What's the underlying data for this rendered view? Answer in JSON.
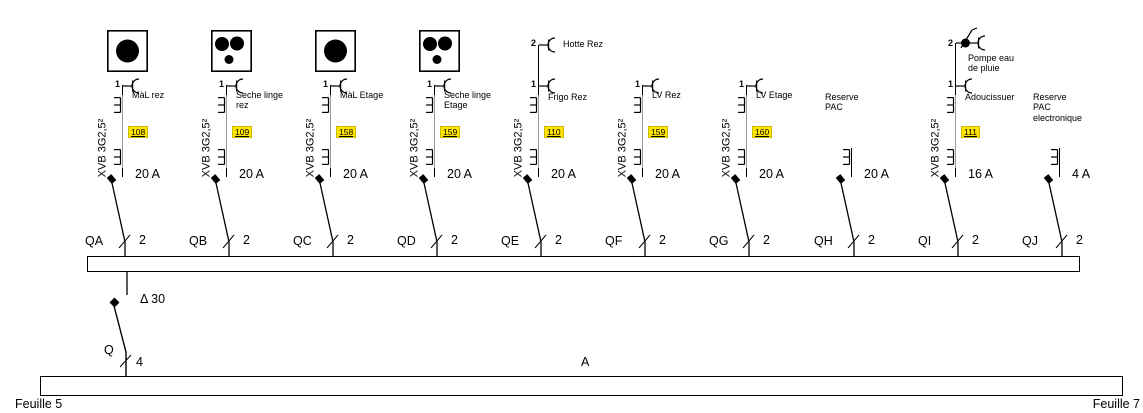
{
  "diagram": {
    "footer": {
      "left": "Feuille 5",
      "right": "Feuille 7"
    },
    "lower_bus_label": "A",
    "main_breaker": {
      "id": "Q",
      "poles": "4",
      "differential": "Δ 30"
    },
    "icons": {
      "washing_machine": "washing-machine-icon",
      "tumble_dryer": "tumble-dryer-icon",
      "pump_switch": "pump-switch-icon",
      "socket_outlet": "socket-outlet-icon"
    },
    "colors": {
      "highlight": "#ffe600",
      "cable_gray": "#9a9a9a"
    },
    "branches": [
      {
        "id": "QA",
        "poles": "2",
        "cable": "XVB 3G2,5²",
        "circuit": "108",
        "amp": "20 A",
        "appliance_icon": "washing-machine-icon",
        "outlets": [
          {
            "n": "1",
            "label": "MàL rez"
          }
        ]
      },
      {
        "id": "QB",
        "poles": "2",
        "cable": "XVB 3G2,5²",
        "circuit": "109",
        "amp": "20 A",
        "appliance_icon": "tumble-dryer-icon",
        "outlets": [
          {
            "n": "1",
            "label": "Seche linge rez"
          }
        ]
      },
      {
        "id": "QC",
        "poles": "2",
        "cable": "XVB 3G2,5²",
        "circuit": "158",
        "amp": "20 A",
        "appliance_icon": "washing-machine-icon",
        "outlets": [
          {
            "n": "1",
            "label": "MàL Etage"
          }
        ]
      },
      {
        "id": "QD",
        "poles": "2",
        "cable": "XVB 3G2,5²",
        "circuit": "159",
        "amp": "20 A",
        "appliance_icon": "tumble-dryer-icon",
        "outlets": [
          {
            "n": "1",
            "label": "Seche linge Etage"
          }
        ]
      },
      {
        "id": "QE",
        "poles": "2",
        "cable": "XVB 3G2,5²",
        "circuit": "110",
        "amp": "20 A",
        "outlets": [
          {
            "n": "2",
            "label": "Hotte Rez"
          },
          {
            "n": "1",
            "label": "Frigo Rez"
          }
        ]
      },
      {
        "id": "QF",
        "poles": "2",
        "cable": "XVB 3G2,5²",
        "circuit": "159",
        "amp": "20 A",
        "outlets": [
          {
            "n": "1",
            "label": "LV Rez"
          }
        ]
      },
      {
        "id": "QG",
        "poles": "2",
        "cable": "XVB 3G2,5²",
        "circuit": "160",
        "amp": "20 A",
        "outlets": [
          {
            "n": "1",
            "label": "LV Etage"
          }
        ]
      },
      {
        "id": "QH",
        "poles": "2",
        "amp": "20 A",
        "label": "Reserve PAC"
      },
      {
        "id": "QI",
        "poles": "2",
        "cable": "XVB 3G2,5²",
        "circuit": "111",
        "amp": "16 A",
        "outlets": [
          {
            "n": "2",
            "label": "Pompe eau de pluie"
          },
          {
            "n": "1",
            "label": "Adoucissuer"
          }
        ]
      },
      {
        "id": "QJ",
        "poles": "2",
        "amp": "4 A",
        "label": "Reserve PAC electronique"
      }
    ]
  }
}
